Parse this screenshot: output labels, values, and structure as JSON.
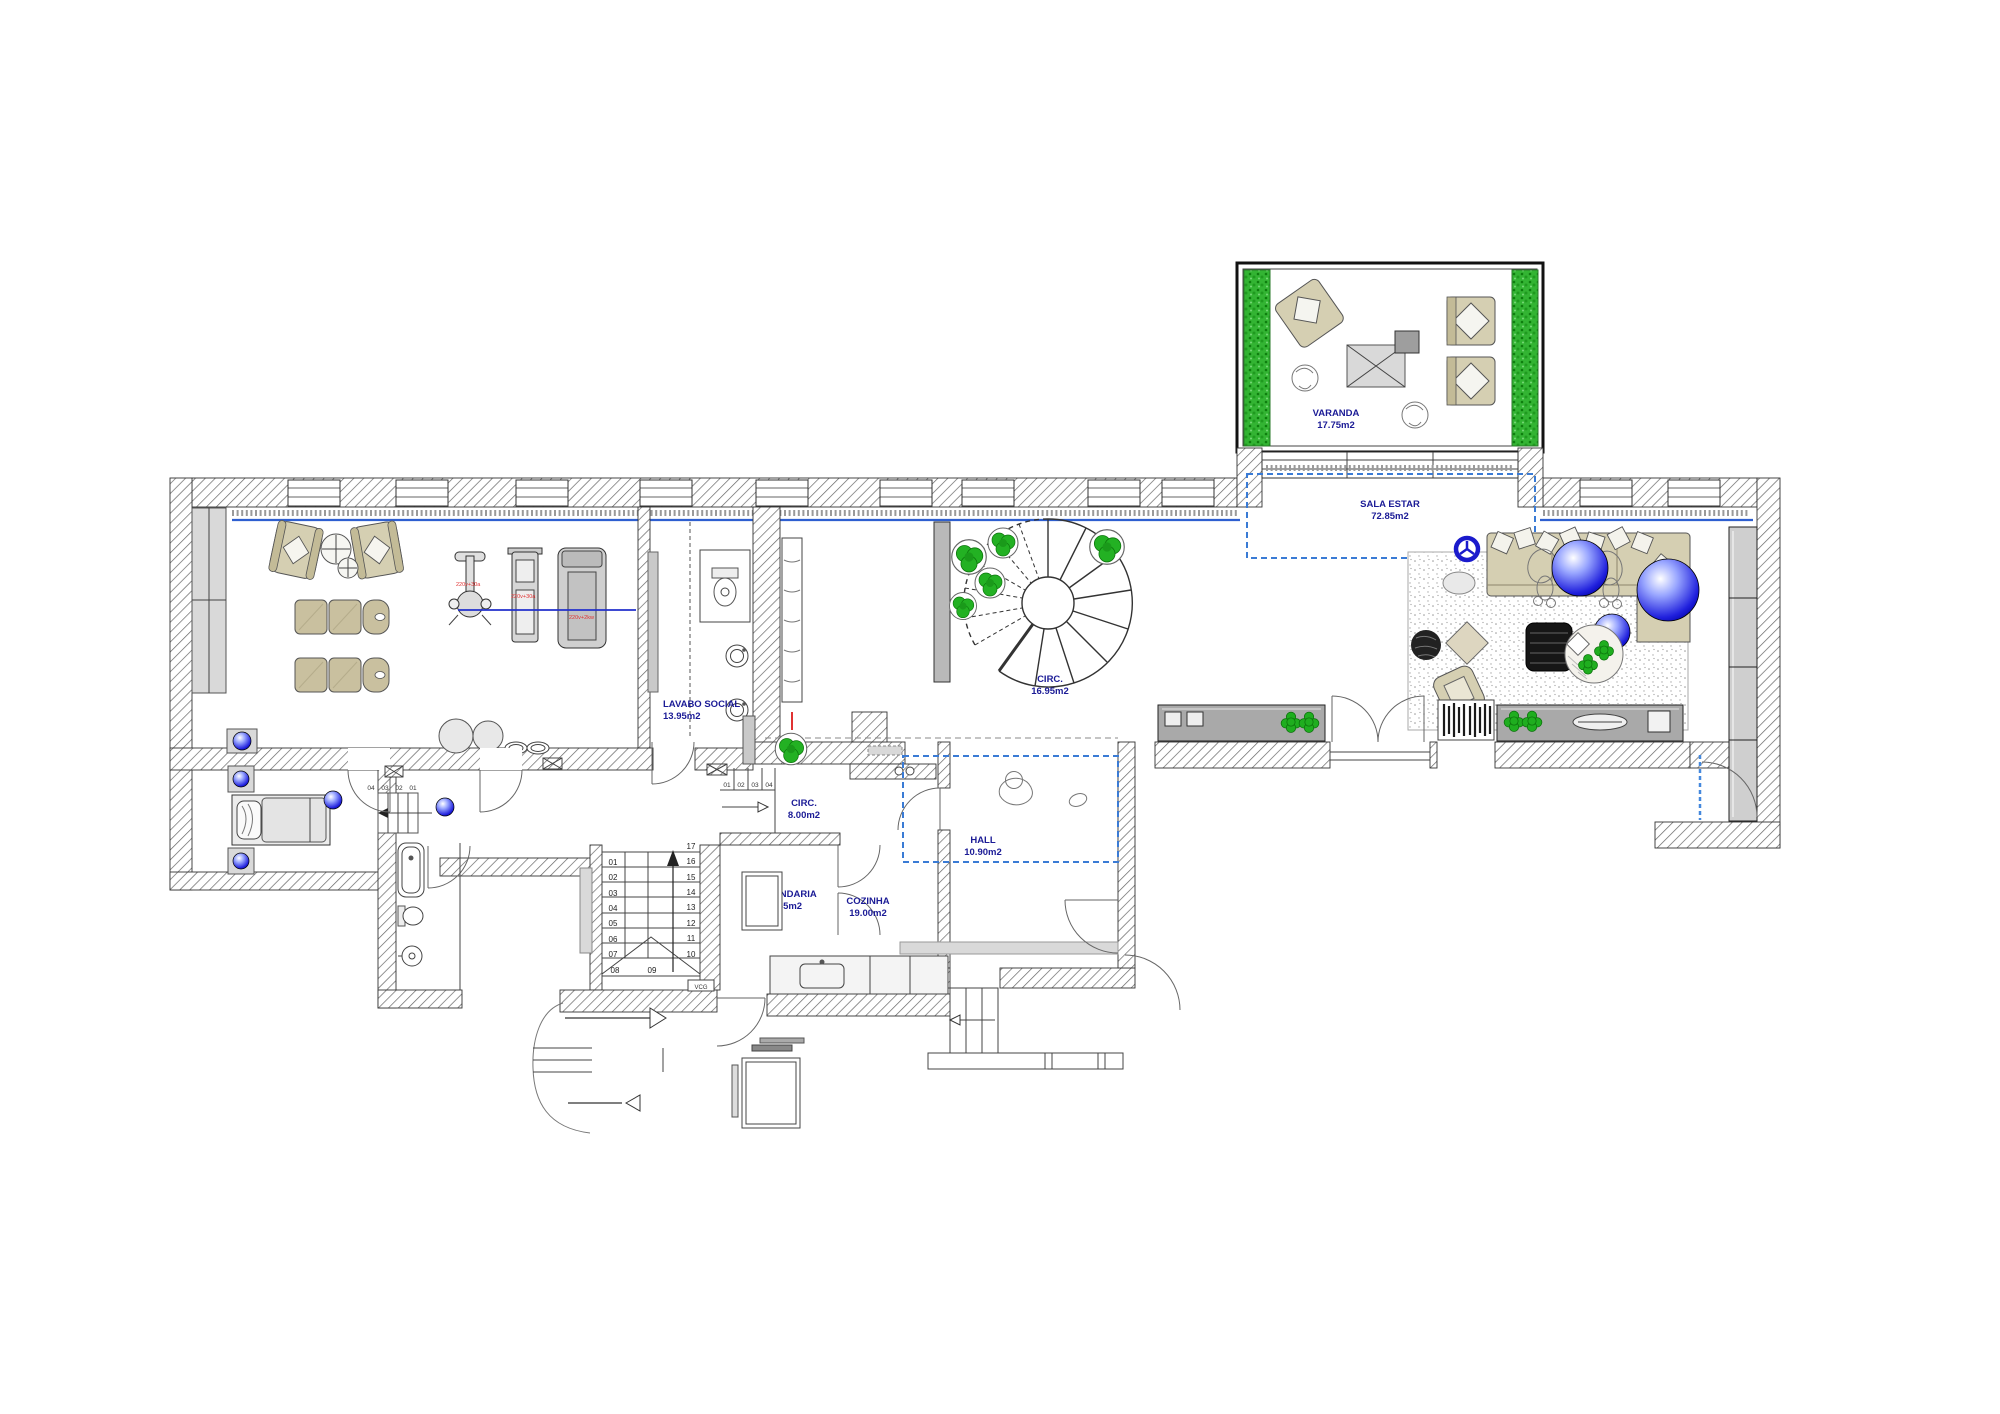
{
  "plan_title": "residential-floor-plan",
  "rooms": {
    "varanda": {
      "name": "VARANDA",
      "area": "17.75m2"
    },
    "sala_estar": {
      "name": "SALA ESTAR",
      "area": "72.85m2"
    },
    "circ_main": {
      "name": "CIRC.",
      "area": "16.95m2"
    },
    "lavabo_social": {
      "name": "LAVABO SOCIAL",
      "area": "13.95m2"
    },
    "circ_small": {
      "name": "CIRC.",
      "area": "8.00m2"
    },
    "hall": {
      "name": "HALL",
      "area": "10.90m2"
    },
    "lavandaria": {
      "name": "LAVANDARIA",
      "area": "3.65m2"
    },
    "cozinha": {
      "name": "COZINHA",
      "area": "19.00m2"
    }
  },
  "stairs": {
    "main_left": [
      "01",
      "02",
      "03",
      "04",
      "05",
      "06",
      "07"
    ],
    "main_bottom": [
      "08",
      "09"
    ],
    "main_right": [
      "17",
      "16",
      "15",
      "14",
      "13",
      "12",
      "11",
      "10"
    ],
    "entry_run": [
      "01",
      "02",
      "03",
      "04"
    ],
    "bedroom_run": [
      "04",
      "03",
      "02",
      "01"
    ],
    "vcg_label": "VCG"
  },
  "equipment_notes": {
    "bike": "220v+30a",
    "gym_machine": "220v+30a",
    "treadmill": "220v+2kw"
  },
  "icons": [
    "plant-icon",
    "clover-plant-icon",
    "blue-orb-lamp-icon",
    "window-icon",
    "door-swing-icon",
    "up-arrow-icon"
  ],
  "colors": {
    "label_blue": "#1b1b96",
    "accent_blue_line": "#2e5fd0",
    "dashed_blue": "#3a7bd5",
    "orb_blue": "#1822e0",
    "plant_green": "#23b123",
    "hedge_green": "#33b433",
    "furniture_beige": "#d5cfb2",
    "wall_gray": "#b9b9b9",
    "note_red": "#e03232"
  }
}
